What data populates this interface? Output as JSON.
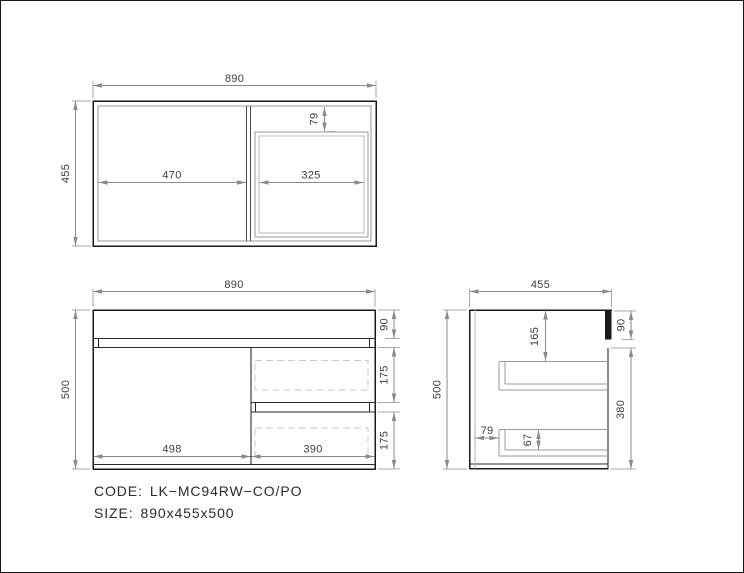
{
  "footer": {
    "code_label": "CODE:",
    "code_value": "LK−MC94RW−CO/PO",
    "size_label": "SIZE:",
    "size_value": "890x455x500"
  },
  "top_view": {
    "overall_width": "890",
    "overall_depth": "455",
    "left_compartment_width": "470",
    "basin_width": "325",
    "basin_front_offset": "79"
  },
  "front_view": {
    "overall_width": "890",
    "overall_height": "500",
    "top_panel_height": "90",
    "upper_drawer_height": "175",
    "lower_drawer_height": "175",
    "door_width": "498",
    "drawer_width": "390"
  },
  "side_view": {
    "overall_depth": "455",
    "overall_height": "500",
    "top_panel_height": "90",
    "cabinet_body_height": "380",
    "drawer_top_inset": "165",
    "drawer_side_height": "67",
    "back_offset": "79"
  },
  "colors": {
    "outline": "#1a1a1a",
    "inner_line": "#2a2a2a",
    "gray_line": "#9a9a9a",
    "light_gray_line": "#b8b8b8",
    "dimension_line": "#8a8a8a",
    "dimension_text": "#3d3d3d",
    "dashed_line": "#c9c9c9",
    "background": "#ffffff"
  }
}
